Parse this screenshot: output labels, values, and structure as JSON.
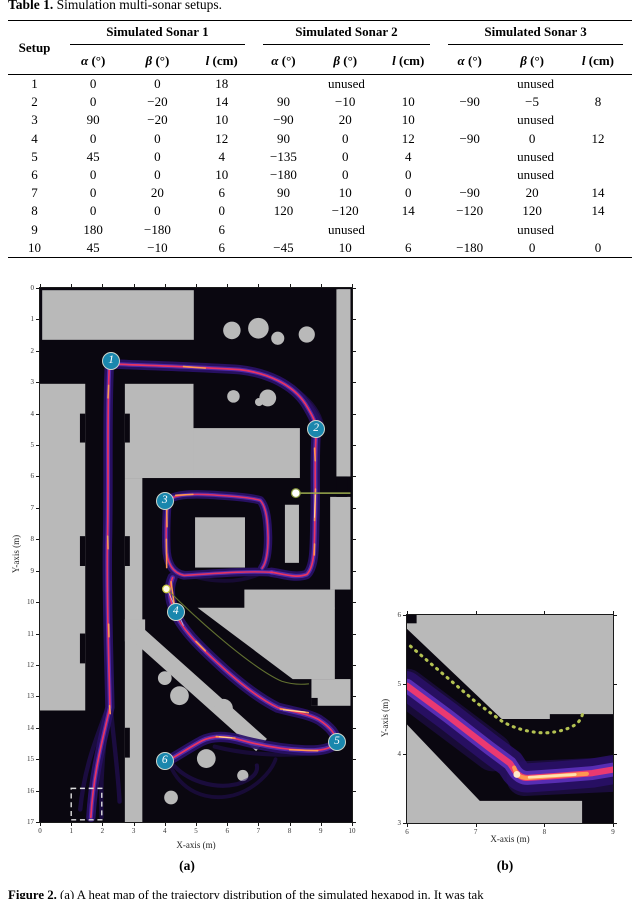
{
  "page": {
    "table_title_bold": "Table 1.",
    "table_title_rest": " Simulation multi-sonar setups.",
    "figure_caption_bold": "Figure 2.",
    "figure_caption_rest": " (a) A heat map of the trajectory distribution of the simulated hexapod in. It was tak"
  },
  "table": {
    "setup_header": "Setup",
    "groups": [
      "Simulated Sonar 1",
      "Simulated Sonar 2",
      "Simulated Sonar 3"
    ],
    "subcols": [
      {
        "sym": "α",
        "unit": "(°)"
      },
      {
        "sym": "β",
        "unit": "(°)"
      },
      {
        "sym": "l",
        "unit": "(cm)"
      }
    ],
    "unused_label": "unused",
    "rows": [
      {
        "setup": "1",
        "sonars": [
          [
            "0",
            "0",
            "18"
          ],
          "unused",
          "unused"
        ]
      },
      {
        "setup": "2",
        "sonars": [
          [
            "0",
            "−20",
            "14"
          ],
          [
            "90",
            "−10",
            "10"
          ],
          [
            "−90",
            "−5",
            "8"
          ]
        ]
      },
      {
        "setup": "3",
        "sonars": [
          [
            "90",
            "−20",
            "10"
          ],
          [
            "−90",
            "20",
            "10"
          ],
          "unused"
        ]
      },
      {
        "setup": "4",
        "sonars": [
          [
            "0",
            "0",
            "12"
          ],
          [
            "90",
            "0",
            "12"
          ],
          [
            "−90",
            "0",
            "12"
          ]
        ]
      },
      {
        "setup": "5",
        "sonars": [
          [
            "45",
            "0",
            "4"
          ],
          [
            "−135",
            "0",
            "4"
          ],
          "unused"
        ]
      },
      {
        "setup": "6",
        "sonars": [
          [
            "0",
            "0",
            "10"
          ],
          [
            "−180",
            "0",
            "0"
          ],
          "unused"
        ]
      },
      {
        "setup": "7",
        "sonars": [
          [
            "0",
            "20",
            "6"
          ],
          [
            "90",
            "10",
            "0"
          ],
          [
            "−90",
            "20",
            "14"
          ]
        ]
      },
      {
        "setup": "8",
        "sonars": [
          [
            "0",
            "0",
            "0"
          ],
          [
            "120",
            "−120",
            "14"
          ],
          [
            "−120",
            "120",
            "14"
          ]
        ]
      },
      {
        "setup": "9",
        "sonars": [
          [
            "180",
            "−180",
            "6"
          ],
          "unused",
          "unused"
        ]
      },
      {
        "setup": "10",
        "sonars": [
          [
            "45",
            "−10",
            "6"
          ],
          [
            "−45",
            "10",
            "6"
          ],
          [
            "−180",
            "0",
            "0"
          ]
        ]
      }
    ]
  },
  "figures": {
    "a": {
      "caption": "(a)",
      "xlabel": "X-axis (m)",
      "ylabel": "Y-axis (m)",
      "x_ticks": [
        "0",
        "1",
        "2",
        "3",
        "4",
        "5",
        "6",
        "7",
        "8",
        "9",
        "10"
      ],
      "y_ticks": [
        "0",
        "1",
        "2",
        "3",
        "4",
        "5",
        "6",
        "7",
        "8",
        "9",
        "10",
        "11",
        "12",
        "13",
        "14",
        "15",
        "16",
        "17"
      ],
      "markers": [
        {
          "label": "1",
          "x": 2.28,
          "y": 2.33
        },
        {
          "label": "2",
          "x": 8.85,
          "y": 4.5
        },
        {
          "label": "3",
          "x": 4.0,
          "y": 6.78
        },
        {
          "label": "4",
          "x": 4.35,
          "y": 10.32
        },
        {
          "label": "5",
          "x": 9.52,
          "y": 14.45
        },
        {
          "label": "6",
          "x": 4.0,
          "y": 15.05
        }
      ]
    },
    "b": {
      "caption": "(b)",
      "xlabel": "X-axis (m)",
      "ylabel": "Y-axis (m)",
      "x_ticks": [
        "6",
        "7",
        "8",
        "9"
      ],
      "y_ticks": [
        "3",
        "4",
        "5",
        "6"
      ]
    }
  },
  "colors": {
    "wall_gray": "#b9b9b9",
    "map_background": "#0a0710",
    "trajectory_halo": "#2a1168",
    "trajectory_mid": "#6d3bd6",
    "trajectory_core": "#f0355e",
    "trajectory_hot": "#ff9750",
    "trajectory_hottest": "#ffd9a0",
    "marker_fill": "#1a87ad",
    "annotation_green": "#9aaa4d"
  }
}
